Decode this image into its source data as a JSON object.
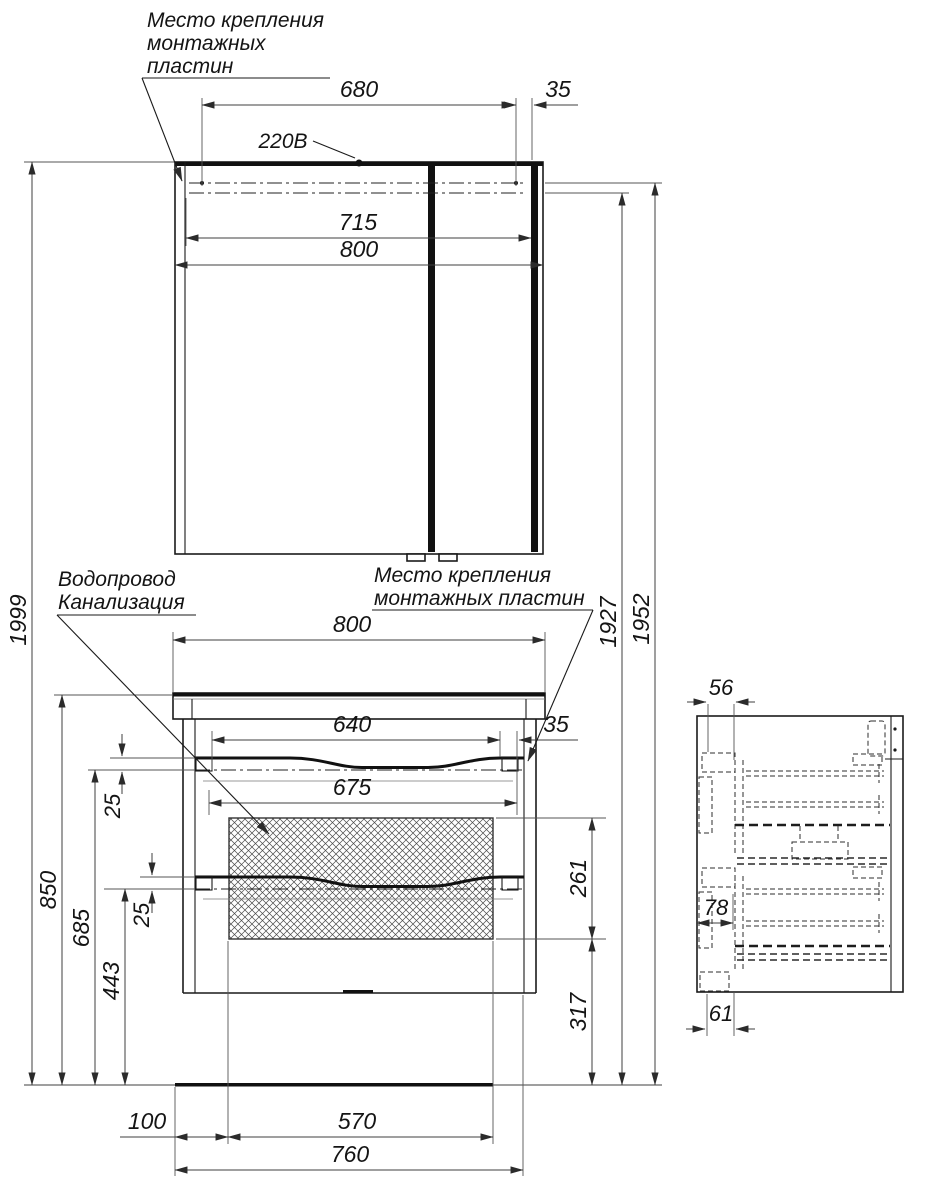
{
  "drawing": {
    "labels": {
      "mounting_plates_top": {
        "line1": "Место крепления",
        "line2": "монтажных",
        "line3": "пластин"
      },
      "power_supply": "220В",
      "plumbing": {
        "line1": "Водопровод",
        "line2": "Канализация"
      },
      "mounting_plates_mid": {
        "line1": "Место крепления",
        "line2": "монтажных пластин"
      }
    },
    "dimensions": {
      "mirror_cabinet": {
        "plates_inner_span": "680",
        "plate_edge_offset": "35",
        "plates_outer_span": "715",
        "overall_width": "800"
      },
      "overall": {
        "total_height": "1999",
        "lower_mount_line_height": "1927",
        "upper_mount_line_height": "1952"
      },
      "vanity": {
        "overall_width": "800",
        "plates_inner_span": "640",
        "plate_edge_offset": "35",
        "plates_outer_span": "675",
        "drawer1_plate_offset": "25",
        "drawer2_plate_offset": "25",
        "service_zone_height": "261",
        "zone_bottom_to_floor": "317",
        "plate2_line_to_floor": "443",
        "plate1_line_to_floor": "685",
        "overall_height": "850",
        "inlet_offset": "100",
        "connections_span": "570",
        "body_width": "760"
      },
      "side_view": {
        "plate_depth": "56",
        "plate_to_back": "78",
        "bottom_plate_depth": "61"
      }
    },
    "colors": {
      "object_line": "#1a1a1a",
      "dimension_line": "#3f3f3f",
      "hidden_line": "#2e2e2e",
      "background": "#ffffff"
    }
  }
}
